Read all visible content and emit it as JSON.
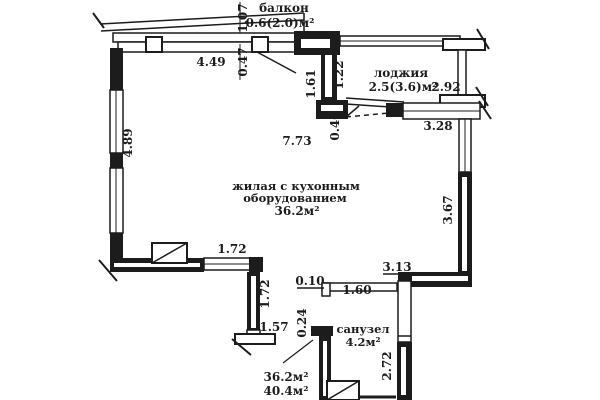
{
  "palette": {
    "ink": "#1c1c1c",
    "paper": "#ffffff"
  },
  "rooms": {
    "balcony": {
      "label": "балкон",
      "area": "0.6(2.0)м²"
    },
    "loggia": {
      "label": "лоджия",
      "area": "2.5(3.6)м²"
    },
    "living": {
      "label_line1": "жилая с кухонным",
      "label_line2": "оборудованием",
      "area": "36.2м²"
    },
    "bathroom": {
      "label": "санузел",
      "area": "4.2м²"
    },
    "summary": {
      "living_area": "36.2м²",
      "total_area": "40.4м²"
    }
  },
  "dimensions": {
    "balcony_depth": "1.07",
    "balcony_width": "4.49",
    "window_offset": "0.47",
    "loggia_left_outer": "1.61",
    "loggia_left_inner": "1.22",
    "loggia_right": "2.92",
    "loggia_bottom": "3.28",
    "loggia_door": "0.40",
    "living_width": "7.73",
    "living_left": "4.89",
    "living_right": "3.67",
    "south_window": "1.72",
    "south_wall_drop": "1.72",
    "south_stub": "1.57",
    "bath_gap": "0.10",
    "bath_top": "3.13",
    "bath_width": "1.60",
    "bath_stub": "0.24",
    "bath_height": "2.72"
  }
}
